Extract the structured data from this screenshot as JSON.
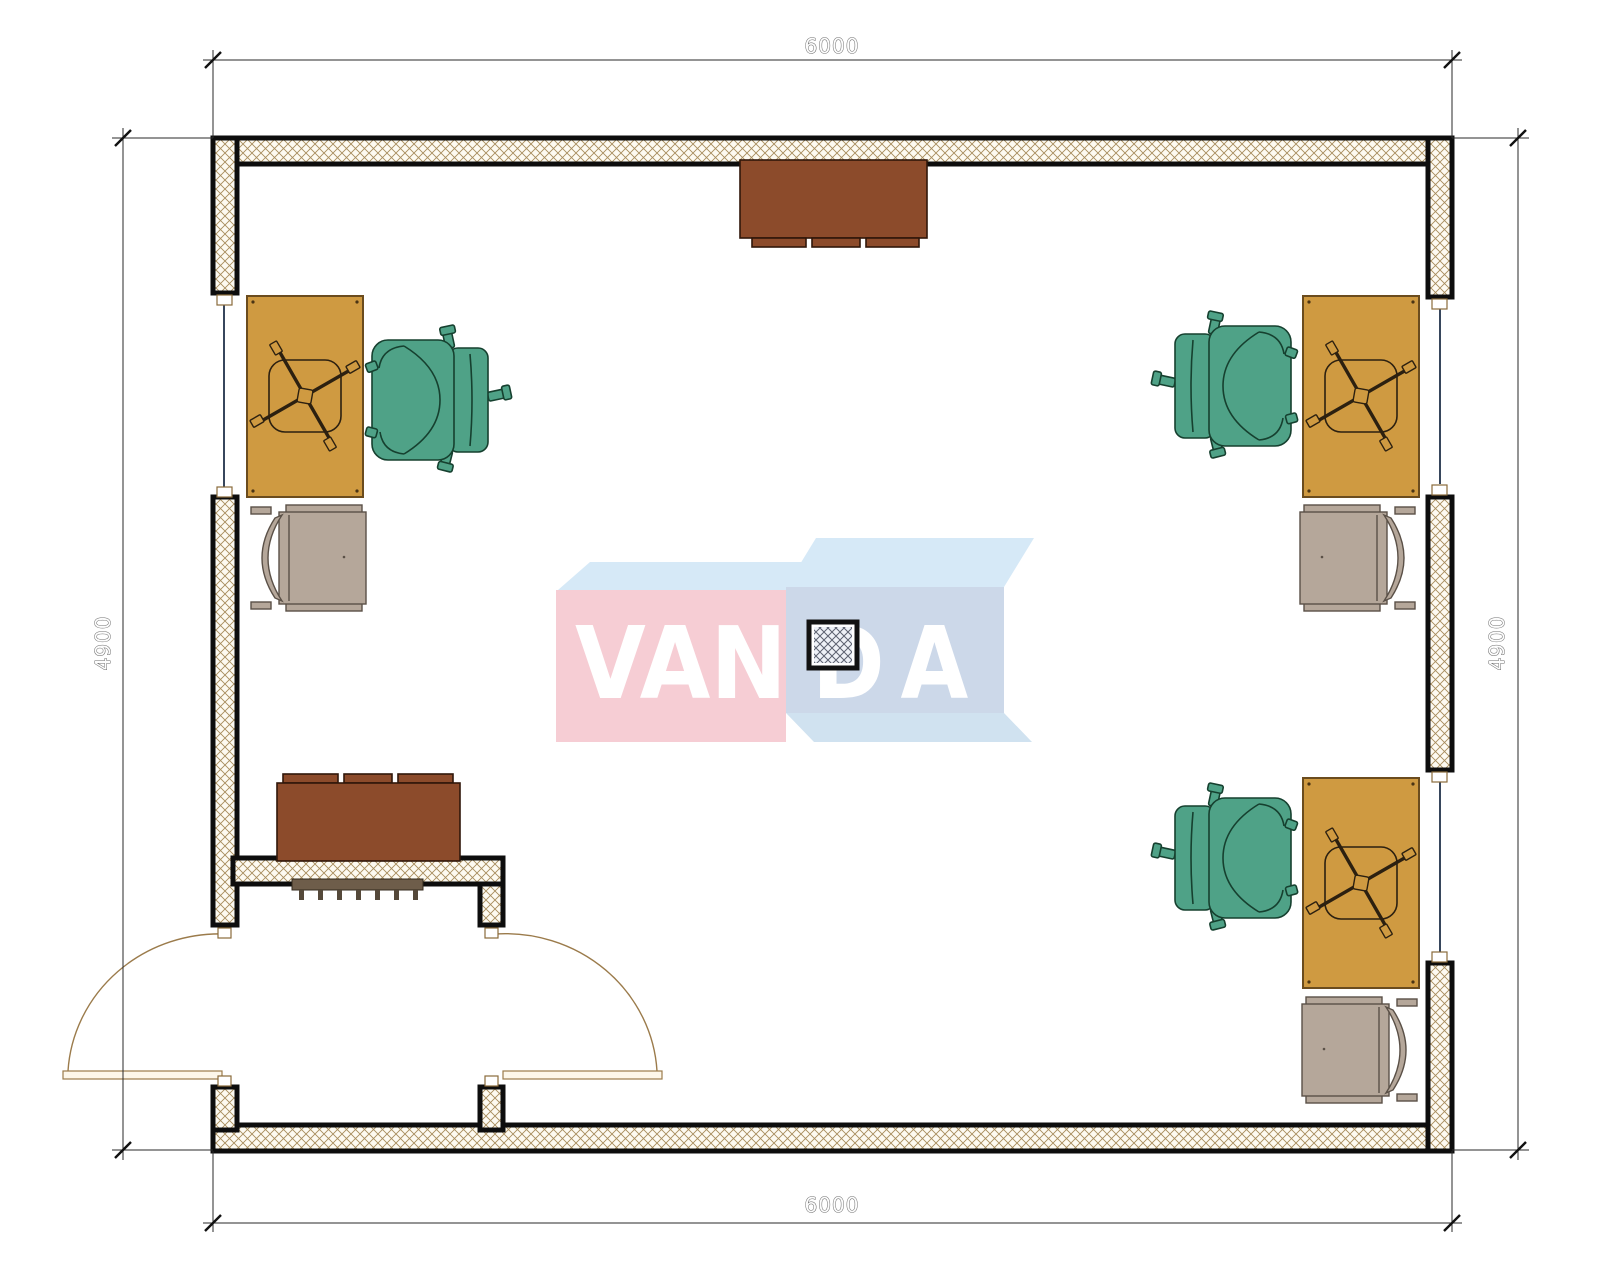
{
  "dimensions": {
    "top": "6000",
    "bottom": "6000",
    "left": "4900",
    "right": "4900"
  },
  "watermark": {
    "part1": "VAN",
    "part2": "DA",
    "brand": "VANDA"
  },
  "colors": {
    "wall_line": "#0d0d0d",
    "wall_hatch": "#a78c5c",
    "wall_fill": "#fdfaf1",
    "desk": "#cf9a41",
    "desk_edge": "#6b4c1e",
    "chair_green": "#4fa287",
    "chair_green_edge": "#16402f",
    "chair_gray": "#b5a79a",
    "chair_gray_edge": "#5a5047",
    "cabinet": "#8c4b2b",
    "cabinet_edge": "#30170a",
    "radiator": "#6e5d4a",
    "door": "#9b7b4b",
    "window_line": "#37465c",
    "dim_line": "#2a2a2a",
    "dim_text_fill": "#fdfdfd",
    "dim_text_outline": "#6a6a6a",
    "wm_pink": "#f6cdd4",
    "wm_blue_front": "#ccd8e9",
    "wm_blue_top": "#d6e9f7",
    "wm_text": "#ffffff"
  }
}
